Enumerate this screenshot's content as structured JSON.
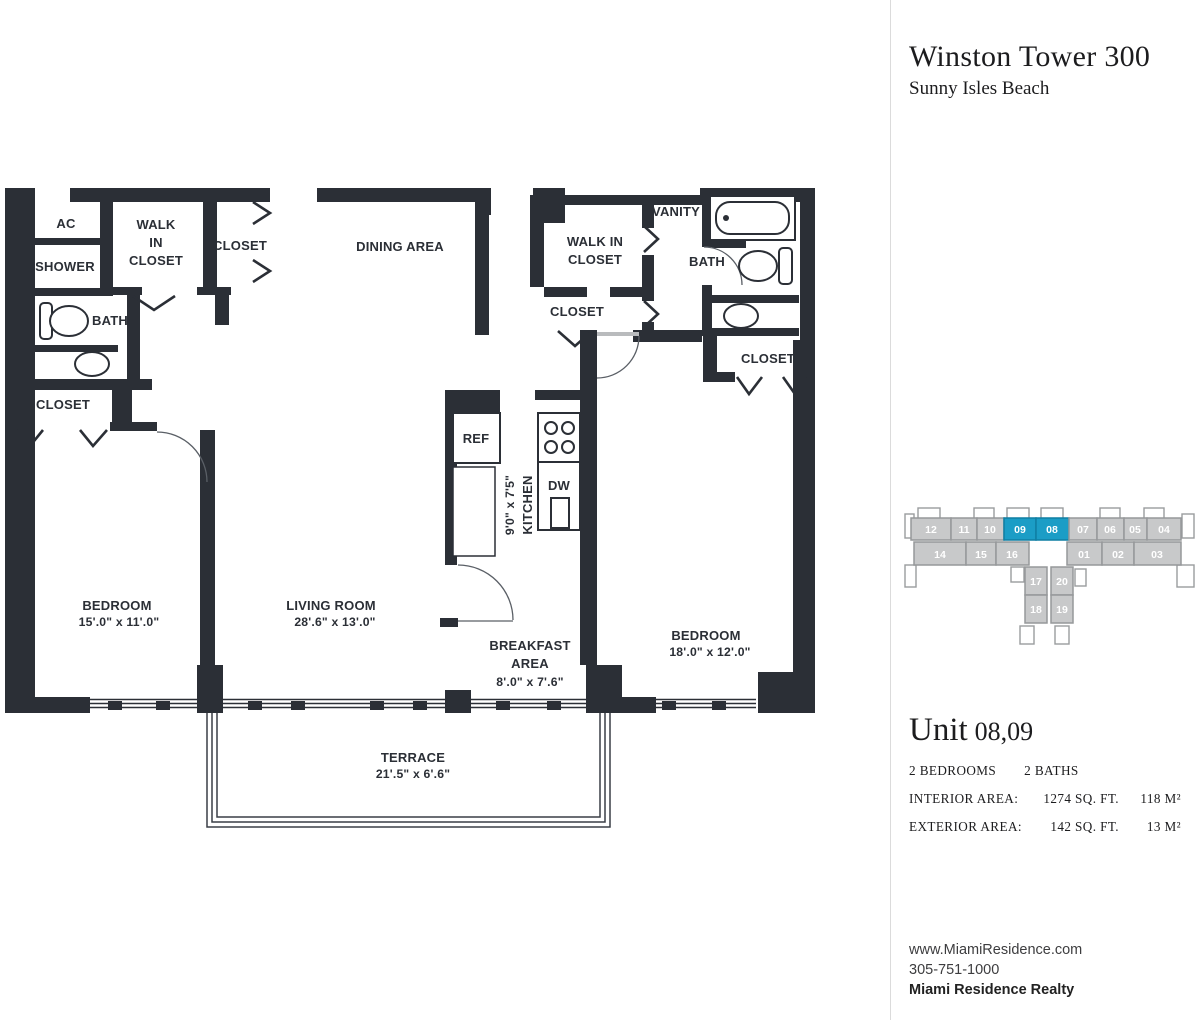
{
  "colors": {
    "wall": "#2B2F36",
    "accent": "#1B9DC6",
    "unit-fill": "#C8C9CA",
    "unit-border": "#96989A",
    "ink": "#1C1C1E",
    "muted": "#3D3D3F",
    "divider": "#DBDBDB"
  },
  "panel": {
    "building_name": "Winston Tower 300",
    "location": "Sunny Isles Beach",
    "unit_word": "Unit",
    "unit_number": "08,09",
    "bedrooms": "2 BEDROOMS",
    "baths": "2 BATHS",
    "interior": {
      "label": "INTERIOR AREA:",
      "sqft": "1274 SQ. FT.",
      "m2": "118 M²"
    },
    "exterior": {
      "label": "EXTERIOR AREA:",
      "sqft": "142 SQ. FT.",
      "m2": "13 M²"
    },
    "footer": {
      "website": "www.MiamiResidence.com",
      "phone": "305-751-1000",
      "company": "Miami Residence Realty"
    }
  },
  "locator": {
    "units": [
      "12",
      "11",
      "10",
      "09",
      "08",
      "07",
      "06",
      "05",
      "04",
      "14",
      "15",
      "16",
      "01",
      "02",
      "03",
      "17",
      "20",
      "18",
      "19"
    ],
    "highlighted": [
      "09",
      "08"
    ]
  },
  "floorplan": {
    "labels": {
      "ac": "AC",
      "shower": "SHOWER",
      "bath1": "BATH",
      "closet_bed1": "CLOSET",
      "wic1": [
        "WALK",
        "IN",
        "CLOSET"
      ],
      "closet_top": "CLOSET",
      "dining": "DINING AREA",
      "wic2": [
        "WALK IN",
        "CLOSET"
      ],
      "closet_hall": "CLOSET",
      "vanity": "VANITY",
      "bath2": "BATH",
      "closet_bed2": "CLOSET",
      "ref": "REF",
      "dw": "DW",
      "kitchen": {
        "name": "KITCHEN",
        "dims": "9'0\" x 7'5\""
      },
      "breakfast": {
        "line1": "BREAKFAST",
        "line2": "AREA",
        "dims": "8'.0\" x 7'.6\""
      },
      "bedroom1": {
        "name": "BEDROOM",
        "dims": "15'.0\" x 11'.0\""
      },
      "living": {
        "name": "LIVING ROOM",
        "dims": "28'.6\" x 13'.0\""
      },
      "bedroom2": {
        "name": "BEDROOM",
        "dims": "18'.0\" x 12'.0\""
      },
      "terrace": {
        "name": "TERRACE",
        "dims": "21'.5\" x 6'.6\""
      }
    }
  }
}
